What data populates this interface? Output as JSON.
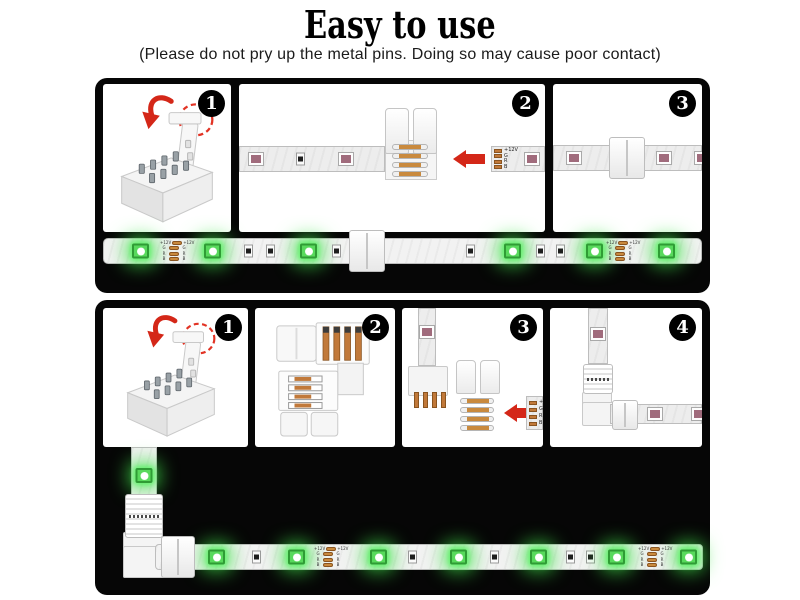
{
  "title": "Easy to use",
  "subtitle": "(Please do not pry up the metal pins. Doing so may cause poor contact)",
  "strip": {
    "pad_labels": [
      "+12V",
      "G",
      "R",
      "B"
    ]
  },
  "sections": [
    {
      "steps": [
        {
          "number": "1"
        },
        {
          "number": "2"
        },
        {
          "number": "3"
        }
      ]
    },
    {
      "steps": [
        {
          "number": "1"
        },
        {
          "number": "2"
        },
        {
          "number": "3"
        },
        {
          "number": "4"
        }
      ]
    }
  ],
  "colors": {
    "panel_background": "#060606",
    "arrow_red": "#d42718",
    "led_green": "#58d95c",
    "copper": "#c1793a",
    "strip_body": "#ededed"
  },
  "icons": {
    "step_badge": "numbered-black-circle",
    "rotate_hint": "curved-red-arrow",
    "insert_direction": "red-left-arrow",
    "pry_warning": "dashed-red-circle"
  }
}
